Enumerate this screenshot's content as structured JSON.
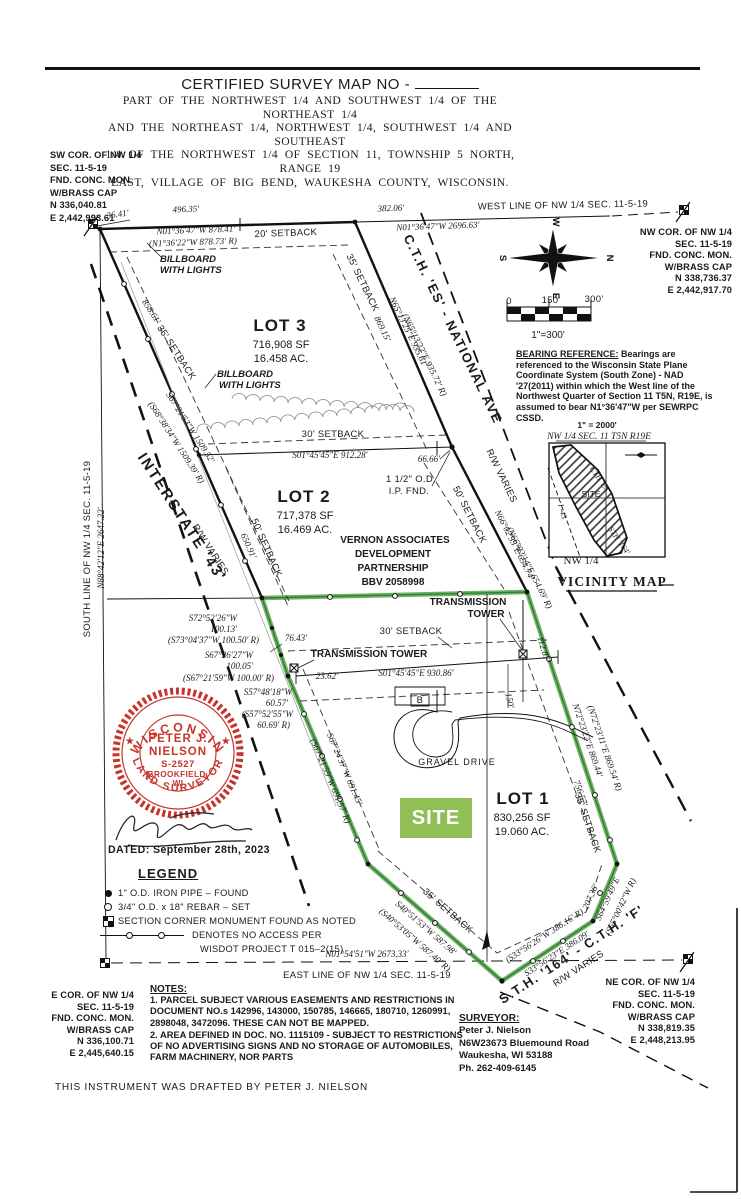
{
  "colors": {
    "boundary_green": "#55a349",
    "site_badge_green": "#8fbf55",
    "seal_red": "#c7342c",
    "ink": "#1a1a1a"
  },
  "header": {
    "title": "CERTIFIED SURVEY MAP NO -",
    "subtitle_lines": [
      "PART OF THE NORTHWEST 1/4 AND SOUTHWEST 1/4 OF THE NORTHEAST 1/4",
      "AND THE NORTHEAST 1/4, NORTHWEST 1/4, SOUTHWEST 1/4 AND SOUTHEAST",
      "1/4 OF THE NORTHWEST 1/4 OF SECTION 11, TOWNSHIP 5 NORTH, RANGE 19",
      "EAST, VILLAGE OF BIG BEND, WAUKESHA COUNTY, WISCONSIN."
    ]
  },
  "corners": {
    "sw": {
      "lines": [
        "SW COR. OF NW 1/4",
        "SEC. 11-5-19",
        "FND. CONC. MON.",
        "W/BRASS CAP",
        "N 336,040.81",
        "E 2,442,993.61"
      ]
    },
    "nw": {
      "lines": [
        "NW COR. OF NW 1/4",
        "SEC. 11-5-19",
        "FND. CONC. MON.",
        "W/BRASS CAP",
        "N 338,736.37",
        "E 2,442,917.70"
      ]
    },
    "ne": {
      "lines": [
        "NE COR. OF NW 1/4",
        "SEC. 11-5-19",
        "FND. CONC. MON.",
        "W/BRASS CAP",
        "N 338,819.35",
        "E 2,448,213.95"
      ]
    },
    "e": {
      "lines": [
        "E COR. OF NW 1/4",
        "SEC. 11-5-19",
        "FND. CONC. MON.",
        "W/BRASS CAP",
        "N 336,100.71",
        "E 2,445,640.15"
      ]
    }
  },
  "bearing_reference": {
    "heading": "BEARING REFERENCE:",
    "body": " Bearings are referenced to the Wisconsin State Plane Coordinate System (South Zone) - NAD '27(2011) within which the West line of the Northwest Quarter of Section 11 T5N, R19E, is assumed to bear N1°36'47\"W per SEWRPC CSSD."
  },
  "seal": {
    "arc_top": "WISCONSIN",
    "arc_bottom": "LAND SURVEYOR",
    "star": "★",
    "line1": "PETER J.",
    "line2": "NIELSON",
    "line3": "S-2527",
    "line4": "BROOKFIELD,",
    "line5": "WI"
  },
  "dated": "DATED: September 28th, 2023",
  "legend": {
    "title": "LEGEND",
    "items": [
      "1\" O.D. IRON PIPE – FOUND",
      "3/4\" O.D. x 18\" REBAR – SET",
      "SECTION CORNER MONUMENT FOUND AS NOTED",
      "DENOTES NO ACCESS PER",
      "WISDOT PROJECT T 015–2(15)"
    ]
  },
  "notes": {
    "title": "NOTES:",
    "items": [
      "1.  PARCEL SUBJECT VARIOUS EASEMENTS AND RESTRICTIONS IN DOCUMENT NO.s 142996, 143000, 150785, 146665, 180710, 1260991, 2898048, 3472096.  THESE CAN NOT BE MAPPED.",
      "2.  AREA DEFINED IN DOC. NO. 1115109 - SUBJECT TO RESTRICTIONS OF NO ADVERTISING SIGNS AND NO STORAGE OF AUTOMOBILES, FARM MACHINERY, NOR PARTS"
    ]
  },
  "surveyor": {
    "title": "SURVEYOR:",
    "lines": [
      "Peter J. Nielson",
      "N6W23673 Bluemound Road",
      "Waukesha, WI  53188",
      "Ph. 262-409-6145"
    ]
  },
  "drafted": "THIS INSTRUMENT WAS DRAFTED BY PETER J. NIELSON",
  "site_badge": "SITE",
  "map_labels": [
    {
      "t": "36.41'",
      "x": 118,
      "y": 217,
      "r": -8,
      "c": "dim"
    },
    {
      "t": "496.35'",
      "x": 186,
      "y": 212,
      "r": -2,
      "c": "dim"
    },
    {
      "t": "382.06'",
      "x": 391,
      "y": 211,
      "r": -2,
      "c": "dim"
    },
    {
      "t": "WEST LINE OF NW 1/4 SEC. 11-5-19",
      "x": 563,
      "y": 208,
      "r": -1,
      "c": "name",
      "n": "west-line-label"
    },
    {
      "t": "N01°36'47\"W 2696.63'",
      "x": 438,
      "y": 229,
      "r": -2,
      "c": "dim"
    },
    {
      "t": "N01°36'47\"W 878.41'",
      "x": 196,
      "y": 233,
      "r": -2,
      "c": "dim"
    },
    {
      "t": "(N1°36'22\"W 878.73' R)",
      "x": 193,
      "y": 245,
      "r": -2,
      "c": "dim"
    },
    {
      "t": "20' SETBACK",
      "x": 286,
      "y": 236,
      "r": -2,
      "c": "name"
    },
    {
      "t": "BILLBOARD",
      "x": 186,
      "y": 262,
      "c": "bb",
      "a": "start",
      "ax": 160
    },
    {
      "t": "WITH LIGHTS",
      "x": 186,
      "y": 273,
      "c": "bb",
      "a": "start",
      "ax": 160
    },
    {
      "t": "BILLBOARD",
      "x": 217,
      "y": 377,
      "c": "bb",
      "a": "start",
      "ax": 217
    },
    {
      "t": "WITH LIGHTS",
      "x": 219,
      "y": 388,
      "c": "bb",
      "a": "start",
      "ax": 219
    },
    {
      "t": "LOT 3",
      "x": 280,
      "y": 331,
      "c": "lot",
      "n": "lot3-title"
    },
    {
      "t": "716,908 SF",
      "x": 281,
      "y": 348,
      "c": "lotsub"
    },
    {
      "t": "16.458 AC.",
      "x": 281,
      "y": 362,
      "c": "lotsub"
    },
    {
      "t": "858.61'",
      "x": 149,
      "y": 313,
      "r": 57,
      "c": "dim"
    },
    {
      "t": "35' SETBACK",
      "x": 174,
      "y": 354,
      "r": 57,
      "c": "name"
    },
    {
      "t": "S67°21'53\"W 1509.52'",
      "x": 188,
      "y": 429,
      "r": 57,
      "c": "dim"
    },
    {
      "t": "(S68°38'34\"W 1509.39' R)",
      "x": 174,
      "y": 444,
      "r": 57,
      "c": "dim"
    },
    {
      "t": "35' SETBACK",
      "x": 360,
      "y": 284,
      "r": 64,
      "c": "name"
    },
    {
      "t": "869.15'",
      "x": 380,
      "y": 330,
      "r": 64,
      "c": "dim"
    },
    {
      "t": "N65°13'25\"E 935.61'",
      "x": 406,
      "y": 333,
      "r": 64,
      "c": "dim"
    },
    {
      "t": "(N65°13'22\"E 935.72' R)",
      "x": 422,
      "y": 356,
      "r": 64,
      "c": "dim"
    },
    {
      "t": "C.T.H. 'ES' - NATIONAL AVE",
      "x": 449,
      "y": 331,
      "r": 64,
      "c": "road",
      "n": "road-cth-es"
    },
    {
      "t": "R/W VARIES",
      "x": 499,
      "y": 477,
      "r": 64,
      "c": "name"
    },
    {
      "t": "N66°02'55\"E 654.74'",
      "x": 512,
      "y": 546,
      "r": 63,
      "c": "dim"
    },
    {
      "t": "(N66°02'14\"E 654.69' R)",
      "x": 527,
      "y": 569,
      "r": 63,
      "c": "dim"
    },
    {
      "t": "50' SETBACK",
      "x": 467,
      "y": 516,
      "r": 63,
      "c": "name"
    },
    {
      "t": "30' SETBACK",
      "x": 333,
      "y": 437,
      "c": "name"
    },
    {
      "t": "S01°45'45\"E 912.28'",
      "x": 330,
      "y": 458,
      "c": "dim"
    },
    {
      "t": "66.66'",
      "x": 429,
      "y": 462,
      "c": "dim"
    },
    {
      "t": "1 1/2\" O.D.",
      "x": 411,
      "y": 482,
      "c": "name"
    },
    {
      "t": "I.P. FND.",
      "x": 409,
      "y": 494,
      "c": "name"
    },
    {
      "t": "LOT 2",
      "x": 304,
      "y": 502,
      "c": "lot",
      "n": "lot2-title"
    },
    {
      "t": "717,378 SF",
      "x": 305,
      "y": 519,
      "c": "lotsub"
    },
    {
      "t": "16.469 AC.",
      "x": 305,
      "y": 533,
      "c": "lotsub"
    },
    {
      "t": "VERNON ASSOCIATES",
      "x": 395,
      "y": 543,
      "c": "nameb"
    },
    {
      "t": "DEVELOPMENT",
      "x": 393,
      "y": 557,
      "c": "nameb"
    },
    {
      "t": "PARTNERSHIP",
      "x": 393,
      "y": 571,
      "c": "nameb"
    },
    {
      "t": "BBV 2058998",
      "x": 393,
      "y": 585,
      "c": "nameb"
    },
    {
      "t": "650.91'",
      "x": 246,
      "y": 547,
      "r": 66,
      "c": "dim"
    },
    {
      "t": "50' SETBACK",
      "x": 264,
      "y": 549,
      "r": 66,
      "c": "name"
    },
    {
      "t": "INTERSTATE '43'",
      "x": 178,
      "y": 520,
      "r": 57,
      "c": "road15",
      "n": "road-i43"
    },
    {
      "t": "R/W VARIES",
      "x": 208,
      "y": 551,
      "r": 57,
      "c": "name"
    },
    {
      "t": "SOUTH LINE OF NW 1/4 SEC. 11-5-19",
      "x": 90,
      "y": 549,
      "r": -90,
      "c": "name"
    },
    {
      "t": "N88°42'12\"E 2647.22'",
      "x": 104,
      "y": 548,
      "r": -90,
      "c": "dim"
    },
    {
      "t": "S72°52'26\"W",
      "x": 237,
      "y": 621,
      "a": "end",
      "c": "dim"
    },
    {
      "t": "100.13'",
      "x": 237,
      "y": 632,
      "a": "end",
      "c": "dim"
    },
    {
      "t": "(S73°04'37\"W 100.50' R)",
      "x": 259,
      "y": 643,
      "a": "end",
      "c": "dim"
    },
    {
      "t": "S67°26'27\"W",
      "x": 253,
      "y": 658,
      "a": "end",
      "c": "dim"
    },
    {
      "t": "100.05'",
      "x": 253,
      "y": 669,
      "a": "end",
      "c": "dim"
    },
    {
      "t": "(S67°21'59\"W 100.00' R)",
      "x": 274,
      "y": 681,
      "a": "end",
      "c": "dim"
    },
    {
      "t": "S57°48'18\"W",
      "x": 292,
      "y": 695,
      "a": "end",
      "c": "dim"
    },
    {
      "t": "60.57'",
      "x": 288,
      "y": 706,
      "a": "end",
      "c": "dim"
    },
    {
      "t": "(S57°52'55\"W",
      "x": 293,
      "y": 717,
      "a": "end",
      "c": "dim"
    },
    {
      "t": "60.69' R)",
      "x": 290,
      "y": 728,
      "a": "end",
      "c": "dim"
    },
    {
      "t": "76.43'",
      "x": 296,
      "y": 641,
      "c": "dim"
    },
    {
      "t": "TRANSMISSION TOWER",
      "x": 369,
      "y": 657,
      "c": "nameb"
    },
    {
      "t": "30' SETBACK",
      "x": 411,
      "y": 634,
      "c": "name"
    },
    {
      "t": "TRANSMISSION",
      "x": 468,
      "y": 605,
      "c": "nameb"
    },
    {
      "t": "TOWER",
      "x": 486,
      "y": 617,
      "c": "nameb"
    },
    {
      "t": "S01°45'45\"E 930.86'",
      "x": 416,
      "y": 676,
      "c": "dim"
    },
    {
      "t": "23.62'",
      "x": 327,
      "y": 679,
      "c": "dim"
    },
    {
      "t": "112.87'",
      "x": 541,
      "y": 650,
      "r": 73,
      "c": "dim"
    },
    {
      "t": "150'",
      "x": 507,
      "y": 701,
      "r": 78,
      "c": "dim"
    },
    {
      "t": "N72°23'22\"E 869.44'",
      "x": 585,
      "y": 741,
      "r": 71,
      "c": "dim"
    },
    {
      "t": "(N72°23'11\"E 869.54' R)",
      "x": 602,
      "y": 749,
      "r": 71,
      "c": "dim"
    },
    {
      "t": "756.57'",
      "x": 578,
      "y": 794,
      "r": 71,
      "c": "dim"
    },
    {
      "t": "35' SETBACK",
      "x": 585,
      "y": 824,
      "r": 71,
      "c": "name"
    },
    {
      "t": "GRAVEL DRIVE",
      "x": 457,
      "y": 765,
      "c": "name9"
    },
    {
      "t": "B",
      "x": 420,
      "y": 703,
      "c": "name"
    },
    {
      "t": "LOT 1",
      "x": 523,
      "y": 804,
      "c": "lot",
      "n": "lot1-title"
    },
    {
      "t": "830,256 SF",
      "x": 522,
      "y": 821,
      "c": "lotsub"
    },
    {
      "t": "19.060 AC.",
      "x": 522,
      "y": 835,
      "c": "lotsub"
    },
    {
      "t": "S67°24'37\"W 691.45'",
      "x": 342,
      "y": 770,
      "r": 67,
      "c": "dim"
    },
    {
      "t": "(S67°21'59\"W 691.57' R)",
      "x": 328,
      "y": 782,
      "r": 67,
      "c": "dim"
    },
    {
      "t": "35' SETBACK",
      "x": 446,
      "y": 913,
      "r": 41,
      "c": "name"
    },
    {
      "t": "S40°51'53\"W 587.98'",
      "x": 424,
      "y": 930,
      "r": 41,
      "c": "dim"
    },
    {
      "t": "(S40°53'05\"W 587.40' R)",
      "x": 413,
      "y": 942,
      "r": 41,
      "c": "dim"
    },
    {
      "t": "N01°54'51\"W 2673.33'",
      "x": 367,
      "y": 957,
      "c": "dim"
    },
    {
      "t": "EAST LINE OF NW 1/4 SEC. 11-5-19",
      "x": 367,
      "y": 978,
      "c": "name",
      "n": "east-line-label"
    },
    {
      "t": "(S33°56'26\"W 386.16' R)",
      "x": 546,
      "y": 938,
      "r": -33,
      "c": "dim"
    },
    {
      "t": "S33°56'23\"E 386.09'",
      "x": 558,
      "y": 956,
      "r": -33,
      "c": "dim"
    },
    {
      "t": "207.36'",
      "x": 593,
      "y": 898,
      "r": -65,
      "c": "dim"
    },
    {
      "t": "S64°59'49\"E",
      "x": 610,
      "y": 900,
      "r": -65,
      "c": "dim"
    },
    {
      "t": "(S65°00'42\"W R)",
      "x": 623,
      "y": 908,
      "r": -65,
      "c": "dim"
    },
    {
      "t": "S.T.H. '164' - C.T.H. 'F'",
      "x": 574,
      "y": 958,
      "r": -33,
      "c": "road",
      "n": "road-sth164"
    },
    {
      "t": "R/W VARIES",
      "x": 580,
      "y": 971,
      "r": -33,
      "c": "name"
    },
    {
      "t": "W",
      "x": 553,
      "y": 222,
      "r": 90,
      "c": "cmp",
      "n": "compass-w"
    },
    {
      "t": "S",
      "x": 500,
      "y": 258,
      "r": 90,
      "c": "cmp",
      "n": "compass-s"
    },
    {
      "t": "N",
      "x": 607,
      "y": 258,
      "r": 90,
      "c": "cmp",
      "n": "compass-n"
    },
    {
      "t": "E",
      "x": 553,
      "y": 296,
      "r": 90,
      "c": "cmp",
      "n": "compass-e"
    },
    {
      "t": "0",
      "x": 509,
      "y": 304,
      "c": "name",
      "n": "scale-tick"
    },
    {
      "t": "150'",
      "x": 551,
      "y": 303,
      "c": "name",
      "n": "scale-tick"
    },
    {
      "t": "300'",
      "x": 594,
      "y": 302,
      "c": "name",
      "n": "scale-tick"
    },
    {
      "t": "1\"=300'",
      "x": 548,
      "y": 338,
      "c": "name11",
      "n": "scale-ratio"
    },
    {
      "t": "1\" = 2000'",
      "x": 597,
      "y": 428,
      "c": "vicb",
      "n": "vicinity-scale"
    },
    {
      "t": "NW 1/4 SEC. 11 T5N R19E",
      "x": 599,
      "y": 439,
      "c": "vicsec",
      "n": "vicinity-section"
    },
    {
      "t": "CTH 'ES'",
      "x": 598,
      "y": 481,
      "r": 55,
      "c": "vic"
    },
    {
      "t": "I -43",
      "x": 560,
      "y": 512,
      "r": 75,
      "c": "vic"
    },
    {
      "t": "SITE",
      "x": 591,
      "y": 497,
      "c": "vicsite"
    },
    {
      "t": "STH '164'",
      "x": 617,
      "y": 542,
      "r": 55,
      "c": "vic"
    },
    {
      "t": "NW 1/4",
      "x": 581,
      "y": 564,
      "c": "vicser"
    },
    {
      "t": "VICINITY MAP",
      "x": 612,
      "y": 586,
      "c": "victitle",
      "n": "vicinity-map-title"
    }
  ]
}
